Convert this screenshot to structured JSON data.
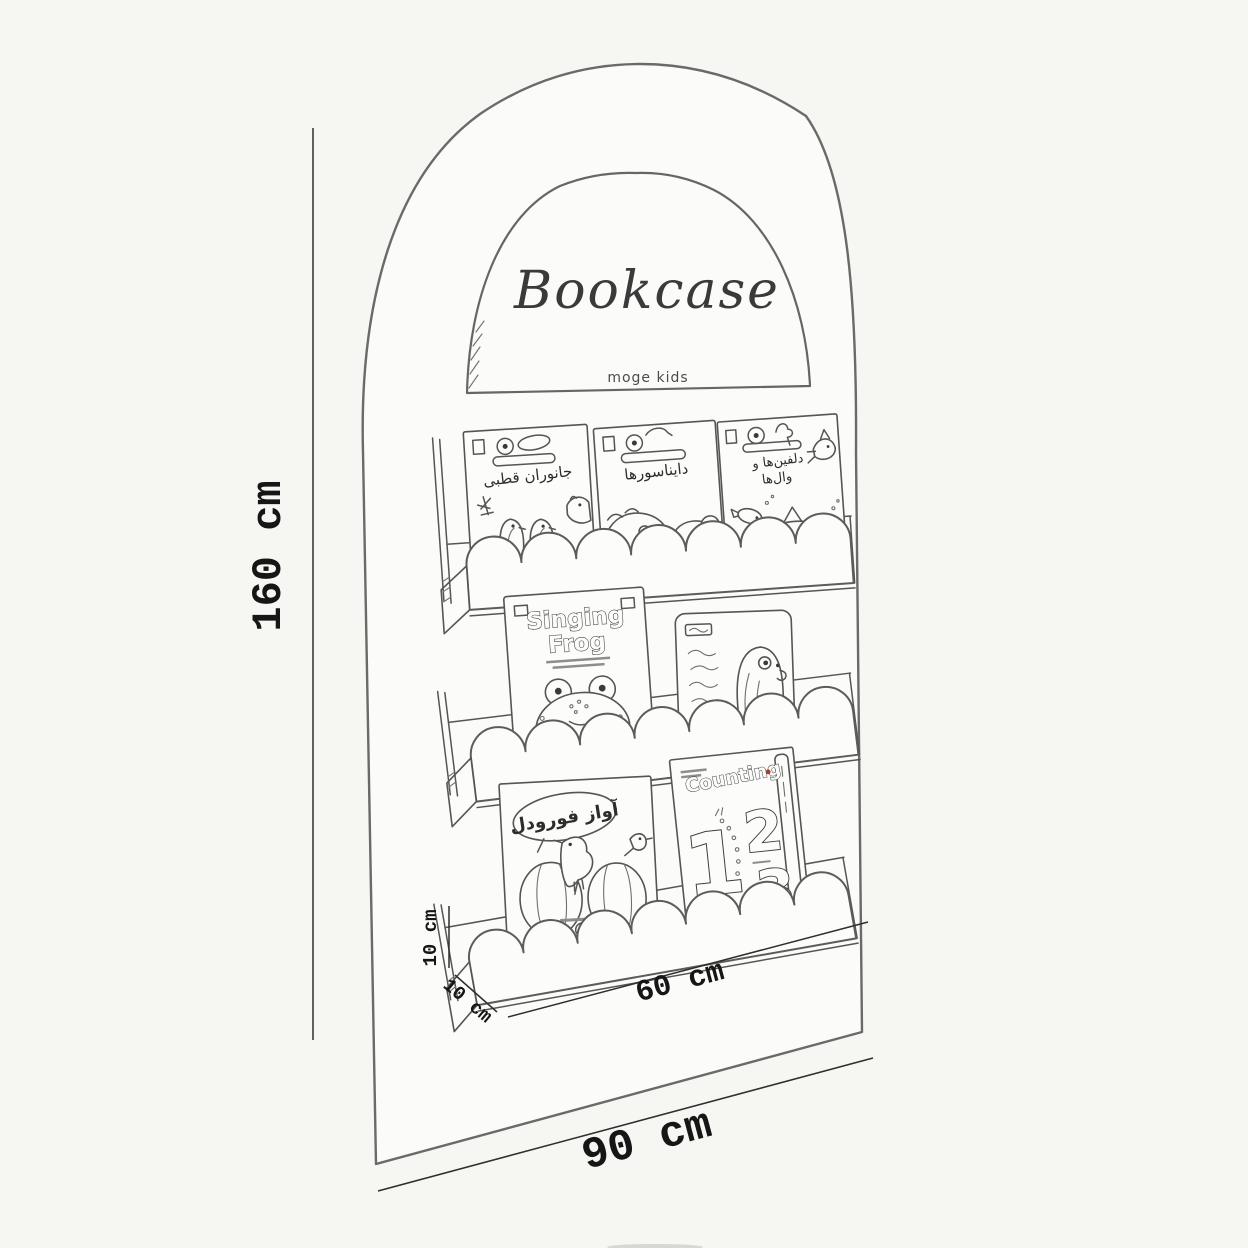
{
  "header": {
    "title": "Bookcase",
    "brand": "moge kids"
  },
  "dimensions": {
    "overall_height": "160 cm",
    "overall_width": "90 cm",
    "shelf_length": "60 cm",
    "shelf_rail_height": "10 cm",
    "shelf_depth": "10 cm"
  },
  "shelves": [
    {
      "position": "top",
      "books": [
        {
          "title": "جانوران قطبی",
          "cover_art": "two-penguins-polar-scene"
        },
        {
          "title": "دایناسورها",
          "cover_art": "dinosaur-head-and-mammoth"
        },
        {
          "title_line1": "دلفین‌ها و",
          "title_line2": "وال‌ها",
          "cover_art": "dolphin-fish-shark"
        }
      ]
    },
    {
      "position": "middle",
      "books": [
        {
          "title_line1": "Singing",
          "title_line2": "Frog",
          "cover_art": "smiling-frog-with-cookie"
        },
        {
          "cover_art": "penguin-with-persian-text-column"
        }
      ]
    },
    {
      "position": "bottom",
      "books": [
        {
          "title": "آواز فورودل",
          "cover_art": "crow-and-bird-on-pumpkins"
        },
        {
          "title": "Counting",
          "numbers": [
            "1",
            "2",
            "3"
          ],
          "cover_art": "outlined-numbers-123"
        }
      ]
    }
  ]
}
